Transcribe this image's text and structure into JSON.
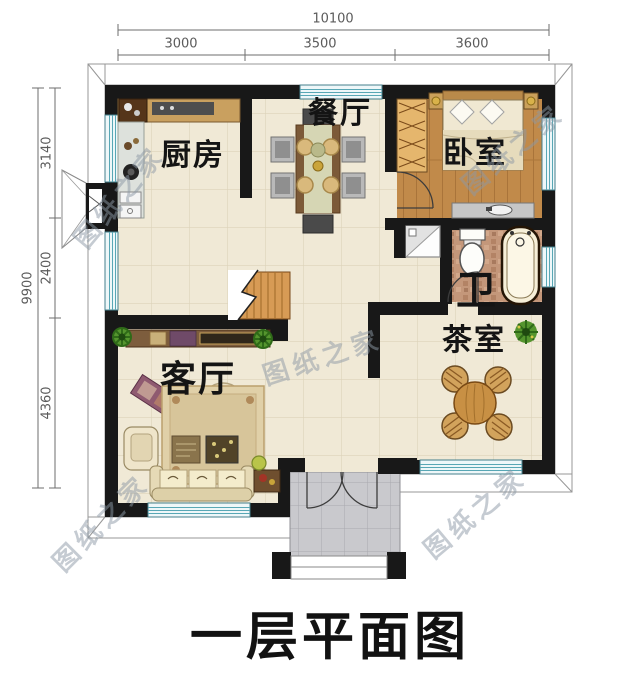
{
  "title": "一层平面图",
  "watermark": "图纸之家",
  "dimensions": {
    "top_total": "10100",
    "top_segments": [
      "3000",
      "3500",
      "3600"
    ],
    "left_total": "9900",
    "left_segments": [
      "3140",
      "2400",
      "4360"
    ]
  },
  "rooms": {
    "dining": "餐厅",
    "kitchen": "厨房",
    "bedroom": "卧室",
    "bathroom": "卫",
    "tea_room": "茶室",
    "living": "客厅"
  },
  "colors": {
    "wall": "#181818",
    "window_teal": "#4d98a6",
    "floor_tile": "#f0e9d6",
    "bedroom_wood": "#c18a4a",
    "bath_mosaic": "#c4977a",
    "porch_gray": "#c9c9cd",
    "stair_wood": "#d79b55",
    "table_wood": "#c89044"
  }
}
